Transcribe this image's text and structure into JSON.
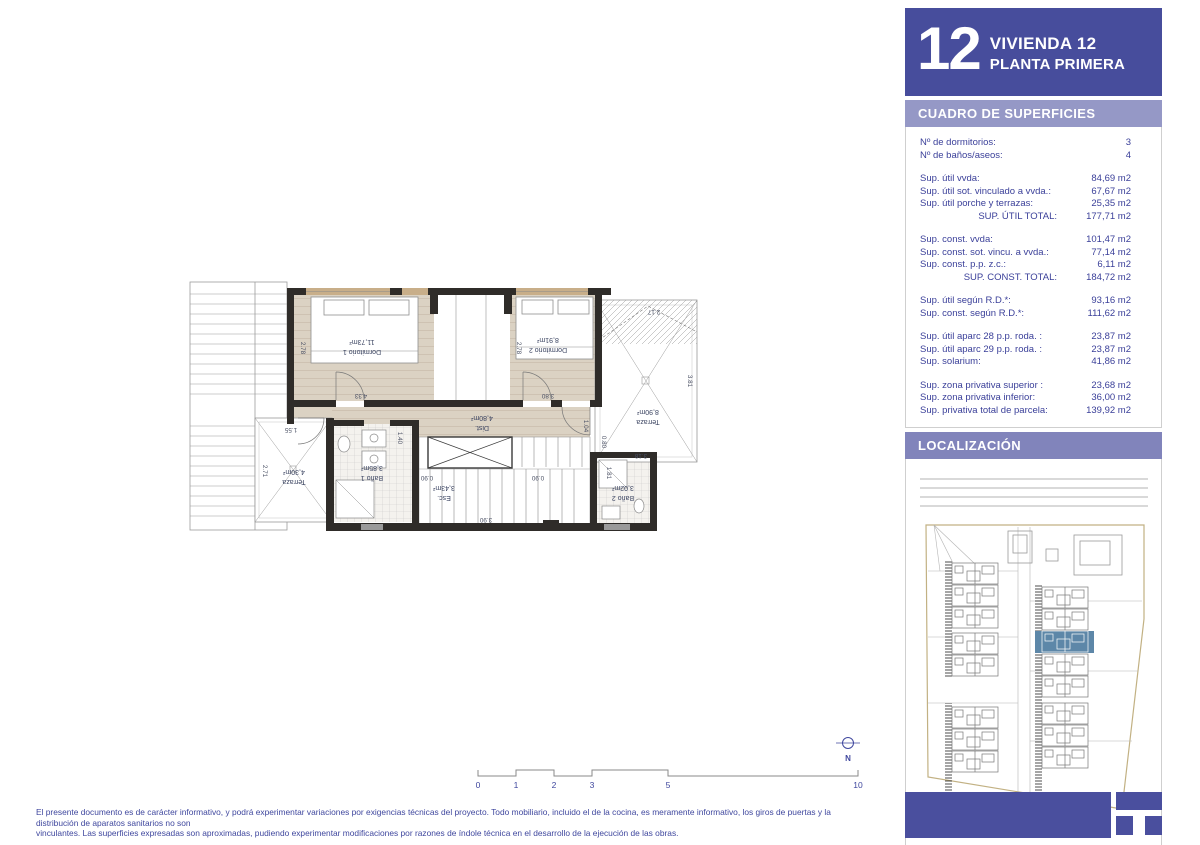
{
  "header": {
    "number": "12",
    "title": "VIVIENDA 12",
    "subtitle": "PLANTA PRIMERA"
  },
  "surfaces": {
    "section_title": "CUADRO DE SUPERFICIES",
    "groups": [
      {
        "rows": [
          {
            "l": "Nº de dormitorios:",
            "v": "3"
          },
          {
            "l": "Nº de baños/aseos:",
            "v": "4"
          }
        ]
      },
      {
        "rows": [
          {
            "l": "Sup. útil vvda:",
            "v": "84,69 m2"
          },
          {
            "l": "Sup. útil sot. vinculado a vvda.:",
            "v": "67,67 m2"
          },
          {
            "l": "Sup. útil porche y terrazas:",
            "v": "25,35 m2"
          },
          {
            "l": "SUP. ÚTIL TOTAL:",
            "v": "177,71 m2"
          }
        ]
      },
      {
        "rows": [
          {
            "l": "Sup. const. vvda:",
            "v": "101,47 m2"
          },
          {
            "l": "Sup. const. sot. vincu. a vvda.:",
            "v": "77,14 m2"
          },
          {
            "l": "Sup. const. p.p. z.c.:",
            "v": "6,11 m2"
          },
          {
            "l": "SUP. CONST. TOTAL:",
            "v": "184,72 m2"
          }
        ]
      },
      {
        "rows": [
          {
            "l": "Sup. útil según R.D.*:",
            "v": "93,16 m2"
          },
          {
            "l": "Sup. const. según R.D.*:",
            "v": "111,62 m2"
          }
        ]
      },
      {
        "rows": [
          {
            "l": "Sup. útil aparc 28 p.p. roda. :",
            "v": "23,87 m2"
          },
          {
            "l": "Sup. útil aparc 29 p.p. roda. :",
            "v": "23,87 m2"
          },
          {
            "l": "Sup. solarium:",
            "v": "41,86 m2"
          }
        ]
      },
      {
        "rows": [
          {
            "l": "Sup. zona privativa superior :",
            "v": "23,68 m2"
          },
          {
            "l": "Sup. zona privativa inferior:",
            "v": "36,00 m2"
          },
          {
            "l": "Sup. privativa total de parcela:",
            "v": "139,92 m2"
          }
        ]
      }
    ]
  },
  "localization": {
    "section_title": "LOCALIZACIÓN"
  },
  "plan": {
    "rooms": [
      {
        "name": "Dormitorio 1",
        "area": "11,73m²"
      },
      {
        "name": "Dormitorio 2",
        "area": "8,91m²"
      },
      {
        "name": "Terraza",
        "area": "8,90m²"
      },
      {
        "name": "Dist.",
        "area": "4,80m²"
      },
      {
        "name": "Terraza",
        "area": "4,30m²"
      },
      {
        "name": "Baño 1",
        "area": "3,85m²"
      },
      {
        "name": "Esc.",
        "area": "3,43m²"
      },
      {
        "name": "Baño 2",
        "area": "3,02m²"
      }
    ],
    "dims": [
      "2.78",
      "4.33",
      "2.78",
      "3.80",
      "2.17",
      "3.81",
      "3.18",
      "1.04",
      "2.71",
      "1.55",
      "0.90",
      "0.90",
      "3.90",
      "1.81",
      "0.80",
      "1.40"
    ]
  },
  "scalebar": {
    "ticks": [
      "0",
      "1",
      "2",
      "3",
      "5",
      "10"
    ]
  },
  "north_label": "N",
  "disclaimer": {
    "line1": "El presente documento es de carácter informativo, y podrá experimentar variaciones por exigencias técnicas del proyecto. Todo mobiliario, incluido el de la cocina, es meramente informativo, los giros de puertas y la distribución de aparatos sanitarios no son",
    "line2": "vinculantes. Las superficies expresadas son aproximadas, pudiendo experimentar modificaciones por razones de índole técnica en el desarrollo de la ejecución de las obras."
  },
  "colors": {
    "headerBlue": "#474d9c",
    "cuadroBar": "#9598c6",
    "localBar": "#8184bb",
    "tableText": "#3a3f99",
    "footerBlue": "#4a4f9e",
    "mapHighlight": "#5d87a8",
    "beige": "#dbd2c3",
    "wall": "#2f2c29",
    "lintel": "#c8ae89",
    "planText": "#3d4663"
  }
}
